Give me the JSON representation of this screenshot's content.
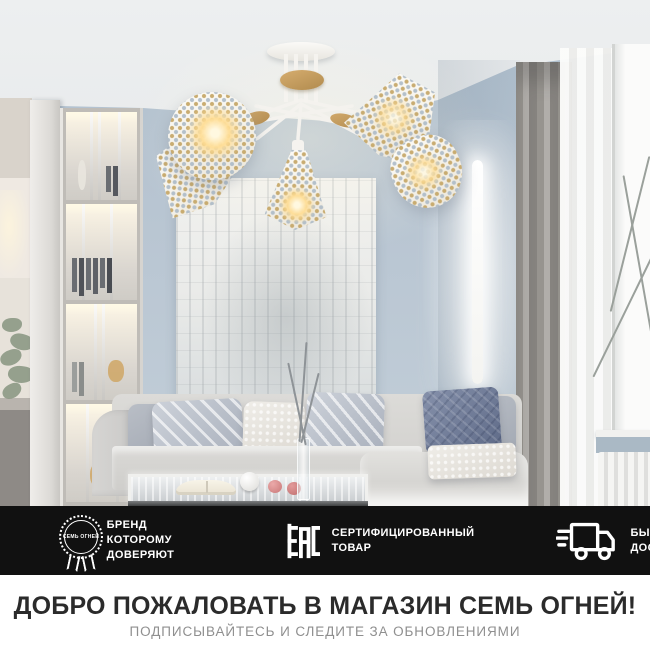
{
  "badge_bar": {
    "background": "#111111",
    "items": [
      {
        "icon": "brand-seal-icon",
        "seal_text": "СЕМЬ ОГНЕЙ",
        "label_line1": "БРЕНД КОТОРОМУ",
        "label_line2": "ДОВЕРЯЮТ"
      },
      {
        "icon": "eac-mark-icon",
        "mark_text": "ЕАС",
        "label_line1": "СЕРТИФИЦИРОВАННЫЙ",
        "label_line2": "ТОВАР"
      },
      {
        "icon": "delivery-truck-icon",
        "label_line1": "БЫСТРАЯ",
        "label_line2": "ДОСТАВКА"
      }
    ]
  },
  "footer": {
    "title": "ДОБРО ПОЖАЛОВАТЬ В МАГАЗИН  СЕМЬ ОГНЕЙ!",
    "subtitle": "ПОДПИСЫВАЙТЕСЬ И СЛЕДИТЕ ЗА ОБНОВЛЕНИЯМИ",
    "title_color": "#2b2b2b",
    "subtitle_color": "#8f8f8f"
  },
  "scene_colors": {
    "wall_blue": "#b7c4d1",
    "ceiling": "#eceeef",
    "wood_accent": "#c9a368",
    "warm_glow": "#ffdd94",
    "curtain_gray": "#97948f",
    "sofa_gray": "#d5d4d1",
    "pillow_blue": "#6a7690"
  }
}
